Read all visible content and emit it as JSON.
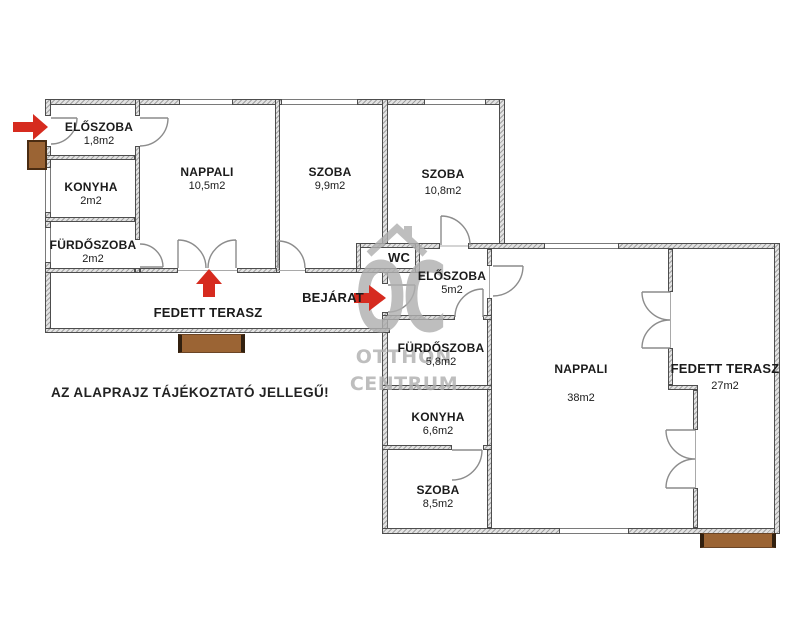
{
  "disclaimer": "AZ ALAPRAJZ TÁJÉKOZTATÓ JELLEGŰ!",
  "entrance_label": "BEJÁRAT",
  "left_building": {
    "rooms": [
      {
        "name": "ELŐSZOBA",
        "area": "1,8m2"
      },
      {
        "name": "KONYHA",
        "area": "2m2"
      },
      {
        "name": "FÜRDŐSZOBA",
        "area": "2m2"
      },
      {
        "name": "NAPPALI",
        "area": "10,5m2"
      },
      {
        "name": "SZOBA",
        "area": "9,9m2"
      },
      {
        "name": "SZOBA",
        "area": "10,8m2"
      },
      {
        "name": "FEDETT TERASZ",
        "area": ""
      }
    ]
  },
  "right_building": {
    "rooms": [
      {
        "name": "WC",
        "area": ""
      },
      {
        "name": "ELŐSZOBA",
        "area": "5m2"
      },
      {
        "name": "FÜRDŐSZOBA",
        "area": "5,8m2"
      },
      {
        "name": "KONYHA",
        "area": "6,6m2"
      },
      {
        "name": "SZOBA",
        "area": "8,5m2"
      },
      {
        "name": "NAPPALI",
        "area": "38m2"
      },
      {
        "name": "FEDETT TERASZ",
        "area": "27m2"
      }
    ]
  },
  "watermark": {
    "monogram": "OC",
    "line1": "OTTHON",
    "line2": "CENTRUM"
  },
  "colors": {
    "arrow_red": "#d62b1f",
    "steps_brown": "#9b6434",
    "wall_grey": "#e2e2e2",
    "watermark_grey": "#b0b0b0",
    "label_black": "#1b1b1b"
  }
}
